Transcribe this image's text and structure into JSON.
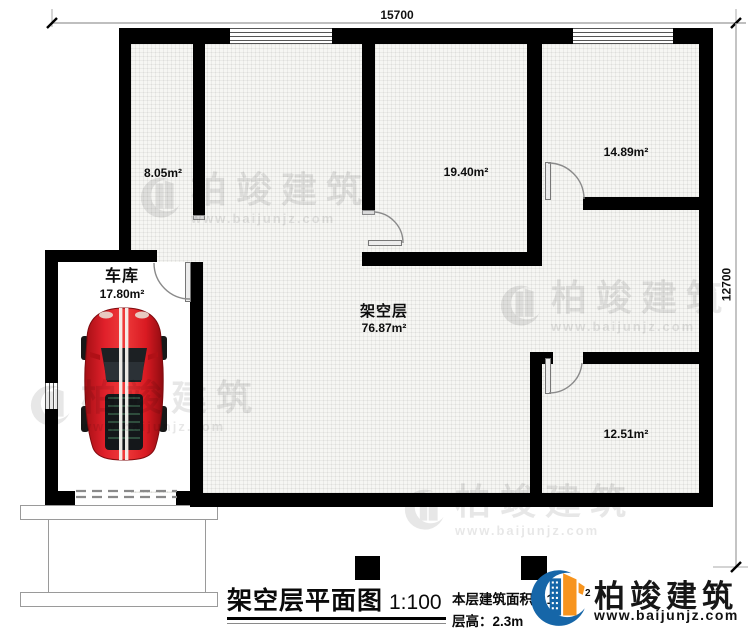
{
  "dimensions": {
    "width_label": "15700",
    "height_label": "12700"
  },
  "rooms": {
    "room_805": {
      "area": "8.05m²"
    },
    "room_1940": {
      "area": "19.40m²"
    },
    "room_1489": {
      "area": "14.89m²"
    },
    "room_1251": {
      "area": "12.51m²"
    },
    "garage": {
      "name": "车库",
      "area": "17.80m²"
    },
    "stilt": {
      "name": "架空层",
      "area": "76.87m²"
    }
  },
  "legend": {
    "title": "架空层平面图",
    "scale": "1:100",
    "area_label": "本层建筑面积：",
    "area_value_visible": "17",
    "area_unit_sup": "2",
    "height_label": "层高：",
    "height_value": "2.3m"
  },
  "brand": {
    "name": "柏竣建筑",
    "url": "www.baijunjz.com"
  },
  "watermark": {
    "name": "柏竣建筑",
    "url": "www.baijunjz.com"
  },
  "colors": {
    "wall": "#000000",
    "brand_blue": "#1666a8",
    "brand_orange": "#f7941e",
    "car_red": "#d61b22"
  }
}
